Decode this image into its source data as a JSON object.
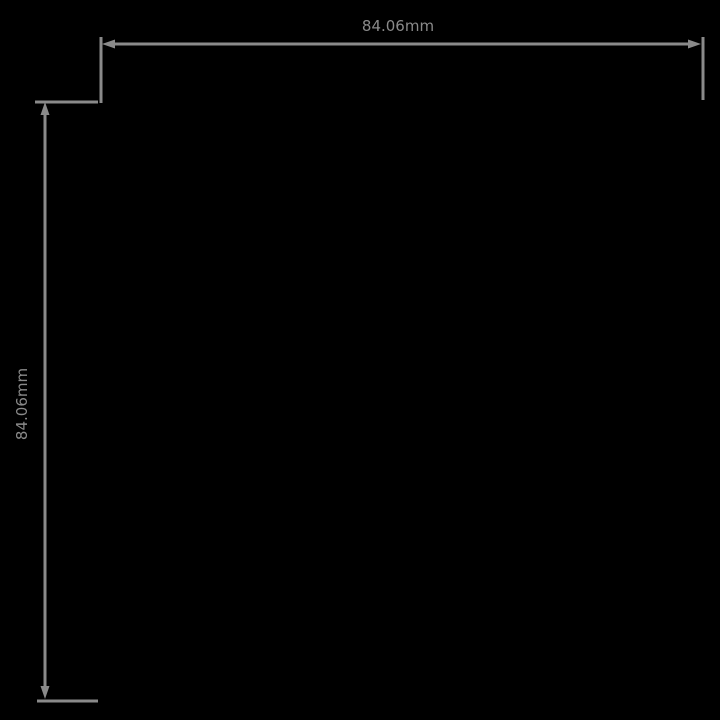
{
  "drawing": {
    "title": "dimension-drawing",
    "background_color": "#000000",
    "line_color": "#8a8a8a",
    "horizontal_dimension": {
      "label": "84.06mm",
      "orientation": "horizontal",
      "position": "top"
    },
    "vertical_dimension": {
      "label": "84.06mm",
      "orientation": "vertical",
      "position": "left"
    }
  }
}
